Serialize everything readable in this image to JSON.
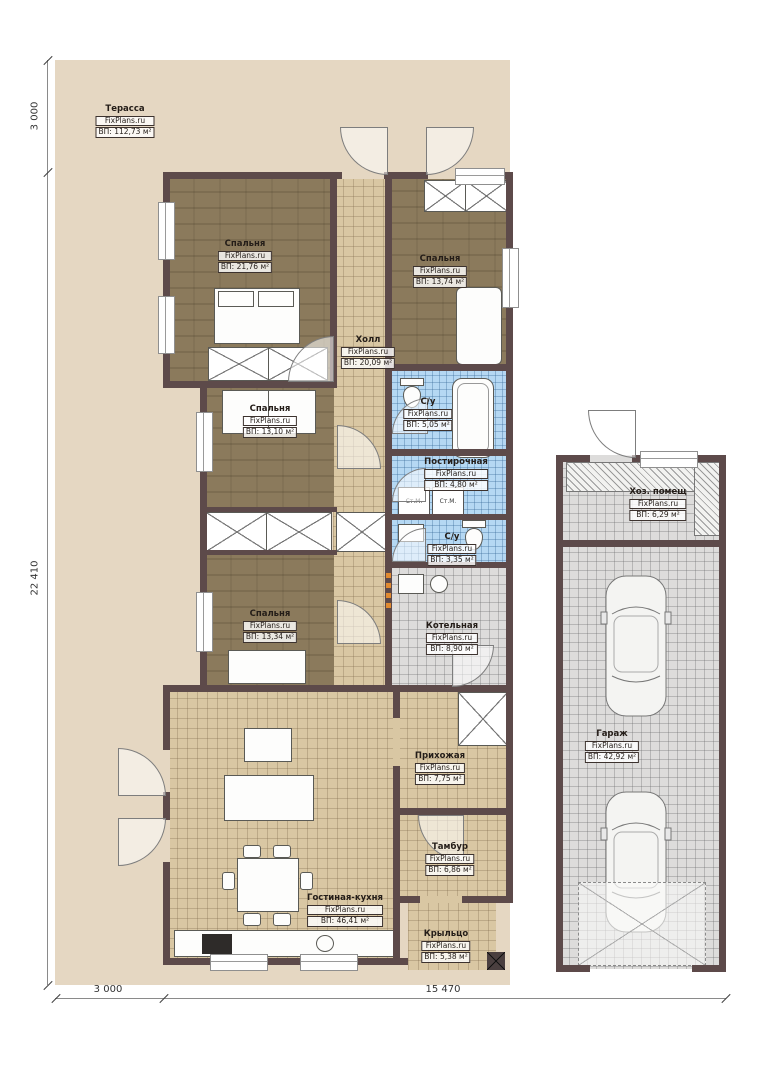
{
  "brand": "FixPlans.ru",
  "dimensions": {
    "left_top": "3 000",
    "left_main": "22 410",
    "bottom_left": "3 000",
    "bottom_right": "15 470"
  },
  "labels": {
    "washer": "Ст.М."
  },
  "colors": {
    "terrace": "#e5d7c2",
    "wall": "#5d4a4a",
    "bedroom_floor": "#8b7a5c",
    "tile_beige": "#d9c7a3",
    "tile_blue": "#b5d8f3",
    "tile_gray": "#dddcdb",
    "accent_dot": "#e08a30"
  },
  "rooms": [
    {
      "name": "Терасса",
      "brand": "FixPlans.ru",
      "area": "ВП: 112,73 м²"
    },
    {
      "name": "Спальня",
      "brand": "FixPlans.ru",
      "area": "ВП: 21,76 м²"
    },
    {
      "name": "Спальня",
      "brand": "FixPlans.ru",
      "area": "ВП: 13,74 м²"
    },
    {
      "name": "Холл",
      "brand": "FixPlans.ru",
      "area": "ВП: 20,09 м²"
    },
    {
      "name": "С/у",
      "brand": "FixPlans.ru",
      "area": "ВП: 5,05 м²"
    },
    {
      "name": "Постирочная",
      "brand": "FixPlans.ru",
      "area": "ВП: 4,80 м²"
    },
    {
      "name": "С/у",
      "brand": "FixPlans.ru",
      "area": "ВП: 3,35 м²"
    },
    {
      "name": "Спальня",
      "brand": "FixPlans.ru",
      "area": "ВП: 13,10 м²"
    },
    {
      "name": "Спальня",
      "brand": "FixPlans.ru",
      "area": "ВП: 13,34 м²"
    },
    {
      "name": "Котельная",
      "brand": "FixPlans.ru",
      "area": "ВП: 8,90 м²"
    },
    {
      "name": "Прихожая",
      "brand": "FixPlans.ru",
      "area": "ВП: 7,75 м²"
    },
    {
      "name": "Тамбур",
      "brand": "FixPlans.ru",
      "area": "ВП: 6,86 м²"
    },
    {
      "name": "Гостиная-кухня",
      "brand": "FixPlans.ru",
      "area": "ВП: 46,41 м²"
    },
    {
      "name": "Крыльцо",
      "brand": "FixPlans.ru",
      "area": "ВП: 5,38 м²"
    },
    {
      "name": "Гараж",
      "brand": "FixPlans.ru",
      "area": "ВП: 42,92 м²"
    },
    {
      "name": "Хоз. помещ",
      "brand": "FixPlans.ru",
      "area": "ВП: 6,29 м²"
    }
  ]
}
